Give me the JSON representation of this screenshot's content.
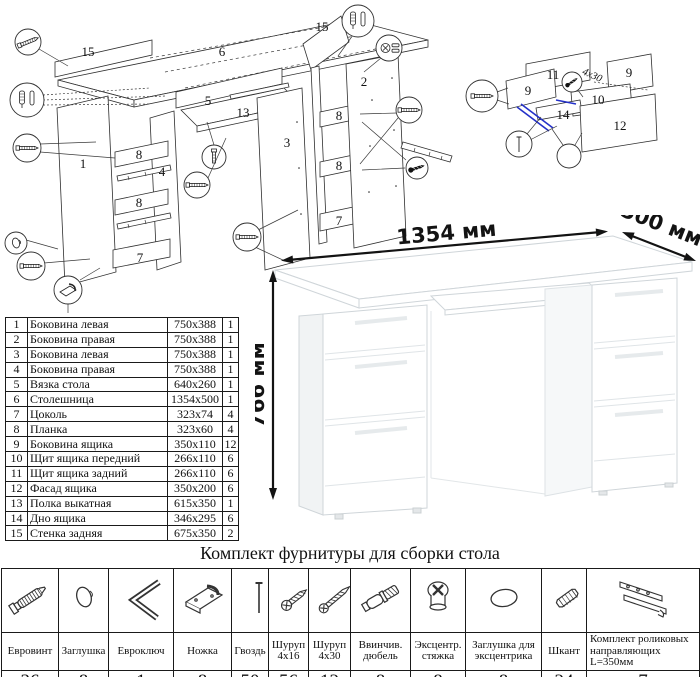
{
  "doc": {
    "title": "Комплект фурнитуры для сборки стола"
  },
  "dimensions": {
    "width": "1354 мм",
    "depth": "500 мм",
    "height": "766 мм"
  },
  "colors": {
    "accent_blue": "#2431c9",
    "line": "#2f2f2f",
    "shade": "#f1f3f4"
  },
  "parts_table": {
    "rows": [
      {
        "num": "1",
        "name": "Боковина левая",
        "size": "750x388",
        "qty": "1"
      },
      {
        "num": "2",
        "name": "Боковина правая",
        "size": "750x388",
        "qty": "1"
      },
      {
        "num": "3",
        "name": "Боковина левая",
        "size": "750x388",
        "qty": "1"
      },
      {
        "num": "4",
        "name": "Боковина правая",
        "size": "750x388",
        "qty": "1"
      },
      {
        "num": "5",
        "name": "Вязка стола",
        "size": "640x260",
        "qty": "1"
      },
      {
        "num": "6",
        "name": "Столешница",
        "size": "1354x500",
        "qty": "1"
      },
      {
        "num": "7",
        "name": "Цоколь",
        "size": "323x74",
        "qty": "4"
      },
      {
        "num": "8",
        "name": "Планка",
        "size": "323x60",
        "qty": "4"
      },
      {
        "num": "9",
        "name": "Боковина ящика",
        "size": "350x110",
        "qty": "12"
      },
      {
        "num": "10",
        "name": "Щит ящика передний",
        "size": "266x110",
        "qty": "6"
      },
      {
        "num": "11",
        "name": "Щит ящика задний",
        "size": "266x110",
        "qty": "6"
      },
      {
        "num": "12",
        "name": "Фасад ящика",
        "size": "350x200",
        "qty": "6"
      },
      {
        "num": "13",
        "name": "Полка выкатная",
        "size": "615x350",
        "qty": "1"
      },
      {
        "num": "14",
        "name": "Дно ящика",
        "size": "346x295",
        "qty": "6"
      },
      {
        "num": "15",
        "name": "Стенка задняя",
        "size": "675x350",
        "qty": "2"
      }
    ]
  },
  "hardware_table": {
    "items": [
      {
        "name": "Евровинт",
        "qty": "36",
        "icon": "euroscrew-icon"
      },
      {
        "name": "Заглушка",
        "qty": "8",
        "icon": "cap-icon"
      },
      {
        "name": "Евроключ",
        "qty": "1",
        "icon": "hexkey-icon"
      },
      {
        "name": "Ножка",
        "qty": "8",
        "icon": "leg-icon"
      },
      {
        "name": "Гвоздь",
        "qty": "50",
        "icon": "nail-icon"
      },
      {
        "name": "Шуруп 4x16",
        "qty": "56",
        "icon": "screw-short-icon"
      },
      {
        "name": "Шуруп 4x30",
        "qty": "12",
        "icon": "screw-long-icon"
      },
      {
        "name": "Ввинчив. дюбель",
        "qty": "8",
        "icon": "dowel-screw-icon"
      },
      {
        "name": "Эксцентр. стяжка",
        "qty": "8",
        "icon": "cam-lock-icon"
      },
      {
        "name": "Заглушка для эксцентрика",
        "qty": "8",
        "icon": "cam-cap-icon"
      },
      {
        "name": "Шкант",
        "qty": "24",
        "icon": "wood-dowel-icon"
      },
      {
        "name": "Комплект роликовых направляющих L=350мм",
        "qty": "7",
        "icon": "drawer-slide-icon"
      }
    ]
  },
  "diagrams": {
    "main_labels": [
      "15",
      "6",
      "15",
      "5",
      "13",
      "1",
      "8",
      "4",
      "8",
      "7",
      "3",
      "2",
      "8",
      "8",
      "7"
    ],
    "drawer_labels": [
      "11",
      "9",
      "9",
      "10",
      "14",
      "12"
    ],
    "screw_note": "4x30"
  }
}
